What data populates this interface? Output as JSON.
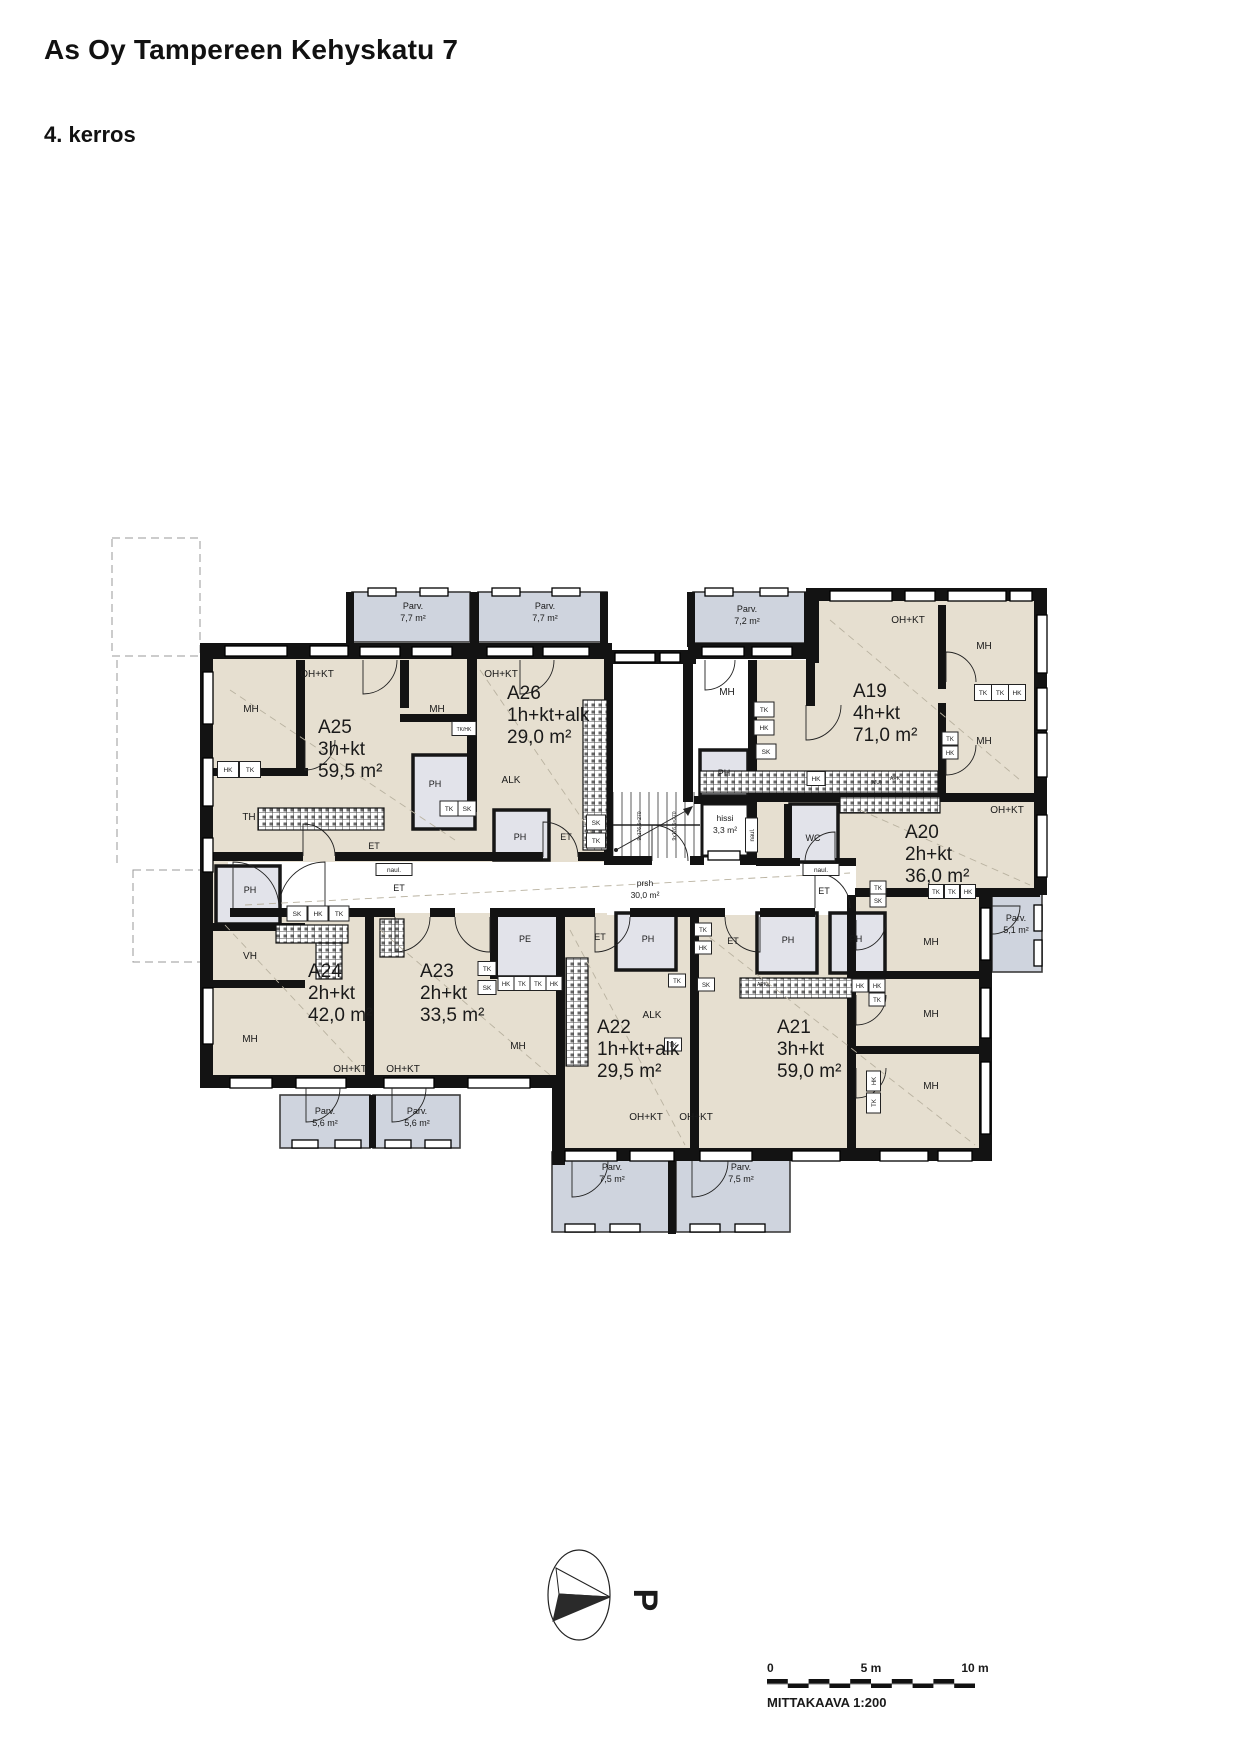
{
  "page": {
    "title": "As Oy Tampereen Kehyskatu 7",
    "floor": "4. kerros"
  },
  "north": {
    "label": "P"
  },
  "scalebar": {
    "zero": "0",
    "mid": "5 m",
    "end": "10 m",
    "caption": "MITTAKAAVA 1:200"
  },
  "colors": {
    "room": "#e6dfd0",
    "balcony": "#cfd4de",
    "wet": "#e2e3ea",
    "wall": "#131313"
  },
  "plan": {
    "apartments": [
      {
        "id": "A25",
        "type": "3h+kt",
        "area": "59,5 m²",
        "x": 318,
        "y": 733
      },
      {
        "id": "A26",
        "type": "1h+kt+alk",
        "area": "29,0 m²",
        "x": 507,
        "y": 699
      },
      {
        "id": "A19",
        "type": "4h+kt",
        "area": "71,0 m²",
        "x": 853,
        "y": 697
      },
      {
        "id": "A20",
        "type": "2h+kt",
        "area": "36,0 m²",
        "x": 905,
        "y": 838
      },
      {
        "id": "A24",
        "type": "2h+kt",
        "area": "42,0 m²",
        "x": 308,
        "y": 977
      },
      {
        "id": "A23",
        "type": "2h+kt",
        "area": "33,5 m²",
        "x": 420,
        "y": 977
      },
      {
        "id": "A22",
        "type": "1h+kt+alk",
        "area": "29,5 m²",
        "x": 597,
        "y": 1033
      },
      {
        "id": "A21",
        "type": "3h+kt",
        "area": "59,0 m²",
        "x": 777,
        "y": 1033
      }
    ],
    "balconies": [
      {
        "name": "Parv.",
        "area": "7,7 m²",
        "x": 413,
        "y": 609
      },
      {
        "name": "Parv.",
        "area": "7,7 m²",
        "x": 545,
        "y": 609
      },
      {
        "name": "Parv.",
        "area": "7,2 m²",
        "x": 747,
        "y": 612
      },
      {
        "name": "Parv.",
        "area": "5,1 m²",
        "x": 1016,
        "y": 921
      },
      {
        "name": "Parv.",
        "area": "5,6 m²",
        "x": 325,
        "y": 1114
      },
      {
        "name": "Parv.",
        "area": "5,6 m²",
        "x": 417,
        "y": 1114
      },
      {
        "name": "Parv.",
        "area": "7,5 m²",
        "x": 612,
        "y": 1170
      },
      {
        "name": "Parv.",
        "area": "7,5 m²",
        "x": 741,
        "y": 1170
      }
    ],
    "labels": [
      {
        "t": "OH+KT",
        "x": 317,
        "y": 677
      },
      {
        "t": "MH",
        "x": 251,
        "y": 712
      },
      {
        "t": "MH",
        "x": 437,
        "y": 712
      },
      {
        "t": "TH",
        "x": 249,
        "y": 820
      },
      {
        "t": "OH+KT",
        "x": 501,
        "y": 677
      },
      {
        "t": "MH",
        "x": 727,
        "y": 695
      },
      {
        "t": "OH+KT",
        "x": 908,
        "y": 623
      },
      {
        "t": "MH",
        "x": 984,
        "y": 649
      },
      {
        "t": "MH",
        "x": 984,
        "y": 744
      },
      {
        "t": "OH+KT",
        "x": 1007,
        "y": 813
      },
      {
        "t": "MH",
        "x": 931,
        "y": 945
      },
      {
        "t": "VH",
        "x": 250,
        "y": 959
      },
      {
        "t": "MH",
        "x": 250,
        "y": 1042
      },
      {
        "t": "OH+KT",
        "x": 350,
        "y": 1072,
        "s": 10
      },
      {
        "t": "OH+KT",
        "x": 403,
        "y": 1072,
        "s": 10
      },
      {
        "t": "MH",
        "x": 518,
        "y": 1049
      },
      {
        "t": "MH",
        "x": 931,
        "y": 1017
      },
      {
        "t": "MH",
        "x": 931,
        "y": 1089
      },
      {
        "t": "OH+KT",
        "x": 646,
        "y": 1120,
        "s": 10
      },
      {
        "t": "OH+KT",
        "x": 696,
        "y": 1120,
        "s": 10
      },
      {
        "t": "ALK",
        "x": 511,
        "y": 783,
        "s": 10
      },
      {
        "t": "ALK",
        "x": 652,
        "y": 1018,
        "s": 10
      },
      {
        "t": "PH",
        "x": 435,
        "y": 787,
        "s": 9
      },
      {
        "t": "ET",
        "x": 374,
        "y": 849,
        "s": 9
      },
      {
        "t": "PH",
        "x": 520,
        "y": 840,
        "s": 9
      },
      {
        "t": "ET",
        "x": 566,
        "y": 840,
        "s": 9
      },
      {
        "t": "PH",
        "x": 724,
        "y": 776,
        "s": 9
      },
      {
        "t": "WC",
        "x": 813,
        "y": 841,
        "s": 9
      },
      {
        "t": "ET",
        "x": 824,
        "y": 894,
        "s": 9
      },
      {
        "t": "PH",
        "x": 250,
        "y": 893,
        "s": 9
      },
      {
        "t": "ET",
        "x": 399,
        "y": 891,
        "s": 9
      },
      {
        "t": "PE",
        "x": 525,
        "y": 942,
        "s": 9
      },
      {
        "t": "ET",
        "x": 600,
        "y": 940,
        "s": 9
      },
      {
        "t": "PH",
        "x": 648,
        "y": 942,
        "s": 9
      },
      {
        "t": "ET",
        "x": 733,
        "y": 944,
        "s": 9
      },
      {
        "t": "PH",
        "x": 788,
        "y": 943,
        "s": 9
      },
      {
        "t": "PH",
        "x": 856,
        "y": 942,
        "s": 9
      },
      {
        "t": "hissi",
        "x": 725,
        "y": 821,
        "s": 8.5
      },
      {
        "t": "3,3 m²",
        "x": 725,
        "y": 833,
        "s": 8.5
      },
      {
        "t": "prsh",
        "x": 645,
        "y": 886,
        "s": 8.5
      },
      {
        "t": "30,0 m²",
        "x": 645,
        "y": 898,
        "s": 8.5
      },
      {
        "t": "HK",
        "x": 228,
        "y": 772,
        "s": 6.5,
        "b": [
          21,
          16
        ]
      },
      {
        "t": "TK",
        "x": 250,
        "y": 772,
        "s": 6.5,
        "b": [
          21,
          16
        ]
      },
      {
        "t": "TK",
        "x": 449,
        "y": 811,
        "s": 6.5,
        "b": [
          18,
          15
        ]
      },
      {
        "t": "SK",
        "x": 467,
        "y": 811,
        "s": 6.5,
        "b": [
          18,
          15
        ]
      },
      {
        "t": "SK",
        "x": 596,
        "y": 825,
        "s": 6.5,
        "b": [
          19,
          15
        ]
      },
      {
        "t": "TK",
        "x": 596,
        "y": 843,
        "s": 6.5,
        "b": [
          19,
          15
        ]
      },
      {
        "t": "TK",
        "x": 764,
        "y": 712,
        "s": 6.5,
        "b": [
          20,
          15
        ]
      },
      {
        "t": "HK",
        "x": 764,
        "y": 730,
        "s": 6.5,
        "b": [
          20,
          15
        ]
      },
      {
        "t": "SK",
        "x": 766,
        "y": 754,
        "s": 6.5,
        "b": [
          20,
          15
        ]
      },
      {
        "t": "TK",
        "x": 983,
        "y": 695,
        "s": 6.5,
        "b": [
          17,
          16
        ]
      },
      {
        "t": "TK",
        "x": 1000,
        "y": 695,
        "s": 6.5,
        "b": [
          17,
          16
        ]
      },
      {
        "t": "HK",
        "x": 1017,
        "y": 695,
        "s": 6.5,
        "b": [
          17,
          16
        ]
      },
      {
        "t": "TK",
        "x": 950,
        "y": 741,
        "s": 6,
        "b": [
          16,
          13
        ]
      },
      {
        "t": "HK",
        "x": 950,
        "y": 755,
        "s": 6,
        "b": [
          16,
          13
        ]
      },
      {
        "t": "HK",
        "x": 816,
        "y": 781,
        "s": 6.5,
        "b": [
          18,
          14
        ]
      },
      {
        "t": "TK",
        "x": 878,
        "y": 890,
        "s": 6,
        "b": [
          16,
          13
        ]
      },
      {
        "t": "SK",
        "x": 878,
        "y": 903,
        "s": 6,
        "b": [
          16,
          13
        ]
      },
      {
        "t": "TK",
        "x": 936,
        "y": 894,
        "s": 6,
        "b": [
          15,
          14
        ]
      },
      {
        "t": "TK",
        "x": 952,
        "y": 894,
        "s": 6,
        "b": [
          15,
          14
        ]
      },
      {
        "t": "HK",
        "x": 968,
        "y": 894,
        "s": 6,
        "b": [
          15,
          14
        ]
      },
      {
        "t": "SK",
        "x": 297,
        "y": 916,
        "s": 6.5,
        "b": [
          20,
          15
        ]
      },
      {
        "t": "HK",
        "x": 318,
        "y": 916,
        "s": 6.5,
        "b": [
          20,
          15
        ]
      },
      {
        "t": "TK",
        "x": 339,
        "y": 916,
        "s": 6.5,
        "b": [
          20,
          15
        ]
      },
      {
        "t": "TK",
        "x": 487,
        "y": 971,
        "s": 6.5,
        "b": [
          18,
          14
        ]
      },
      {
        "t": "SK",
        "x": 487,
        "y": 990,
        "s": 6.5,
        "b": [
          18,
          14
        ]
      },
      {
        "t": "HK",
        "x": 506,
        "y": 986,
        "s": 6,
        "b": [
          16,
          14
        ]
      },
      {
        "t": "TK",
        "x": 522,
        "y": 986,
        "s": 6,
        "b": [
          16,
          14
        ]
      },
      {
        "t": "TK",
        "x": 538,
        "y": 986,
        "s": 6,
        "b": [
          16,
          14
        ]
      },
      {
        "t": "HK",
        "x": 554,
        "y": 986,
        "s": 6,
        "b": [
          16,
          14
        ]
      },
      {
        "t": "TK",
        "x": 677,
        "y": 983,
        "s": 6,
        "b": [
          17,
          13
        ]
      },
      {
        "t": "TK",
        "x": 673,
        "y": 1047,
        "s": 6,
        "b": [
          17,
          13
        ]
      },
      {
        "t": "TK",
        "x": 703,
        "y": 932,
        "s": 6,
        "b": [
          17,
          13
        ]
      },
      {
        "t": "HK",
        "x": 703,
        "y": 950,
        "s": 6,
        "b": [
          17,
          13
        ]
      },
      {
        "t": "SK",
        "x": 706,
        "y": 987,
        "s": 6,
        "b": [
          17,
          13
        ]
      },
      {
        "t": "HK",
        "x": 860,
        "y": 988,
        "s": 6,
        "b": [
          16,
          13
        ]
      },
      {
        "t": "HK",
        "x": 877,
        "y": 988,
        "s": 6,
        "b": [
          16,
          13
        ]
      },
      {
        "t": "TK",
        "x": 877,
        "y": 1002,
        "s": 6,
        "b": [
          16,
          13
        ]
      },
      {
        "t": "naul.",
        "x": 394,
        "y": 872,
        "s": 6.5,
        "b": [
          36,
          12
        ]
      },
      {
        "t": "naul.",
        "x": 821,
        "y": 872,
        "s": 6.5,
        "b": [
          36,
          12
        ]
      },
      {
        "t": "naul.",
        "x": 754,
        "y": 835,
        "s": 6,
        "r": -90,
        "b": [
          34,
          12
        ]
      },
      {
        "t": "HK",
        "x": 876,
        "y": 1081,
        "s": 6,
        "r": -90,
        "b": [
          20,
          14
        ]
      },
      {
        "t": "TK",
        "x": 876,
        "y": 1103,
        "s": 6,
        "r": -90,
        "b": [
          20,
          14
        ]
      },
      {
        "t": "TK/HK",
        "x": 464,
        "y": 731,
        "s": 5,
        "b": [
          24,
          14
        ]
      },
      {
        "t": "APK",
        "x": 895,
        "y": 780,
        "s": 5
      },
      {
        "t": "(MU)",
        "x": 876,
        "y": 784,
        "s": 5
      },
      {
        "t": "APK",
        "x": 762,
        "y": 986,
        "s": 5
      },
      {
        "t": "9x176,5=270",
        "x": 641,
        "y": 826,
        "s": 5,
        "r": -90
      },
      {
        "t": "9x176,5=270",
        "x": 676,
        "y": 826,
        "s": 5,
        "r": -90
      }
    ]
  }
}
